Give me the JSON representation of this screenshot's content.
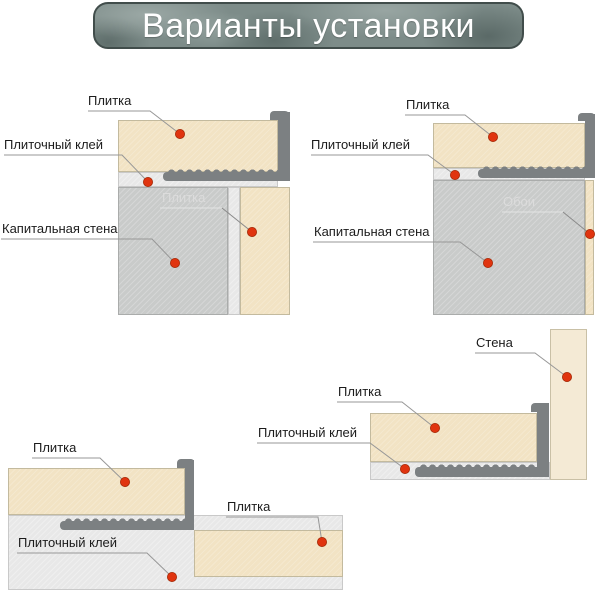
{
  "title": "Варианты установки",
  "colors": {
    "tile": "#f2e3c4",
    "wall_gray": "#c9cbca",
    "wall_beige": "#f4ead5",
    "adhesive": "#e8e8e8",
    "profile": "#7c8082",
    "marker_dot": "#e0340f",
    "banner_base": "#7d8c89",
    "banner_border": "#414d4b",
    "label_text": "#1b1b1b",
    "label_text_light": "#dcdcdc"
  },
  "diagrams": {
    "top_left": {
      "labels": {
        "tile_top": "Плитка",
        "adhesive": "Плиточный клей",
        "wall": "Капитальная стена",
        "tile_side": "Плитка"
      }
    },
    "top_right": {
      "labels": {
        "tile_top": "Плитка",
        "adhesive": "Плиточный клей",
        "wall": "Капитальная стена",
        "wallpaper": "Обои"
      }
    },
    "bottom_left": {
      "labels": {
        "tile_left": "Плитка",
        "tile_right": "Плитка",
        "adhesive": "Плиточный клей"
      }
    },
    "bottom_right": {
      "labels": {
        "wall": "Стена",
        "tile": "Плитка",
        "adhesive": "Плиточный клей"
      }
    }
  }
}
